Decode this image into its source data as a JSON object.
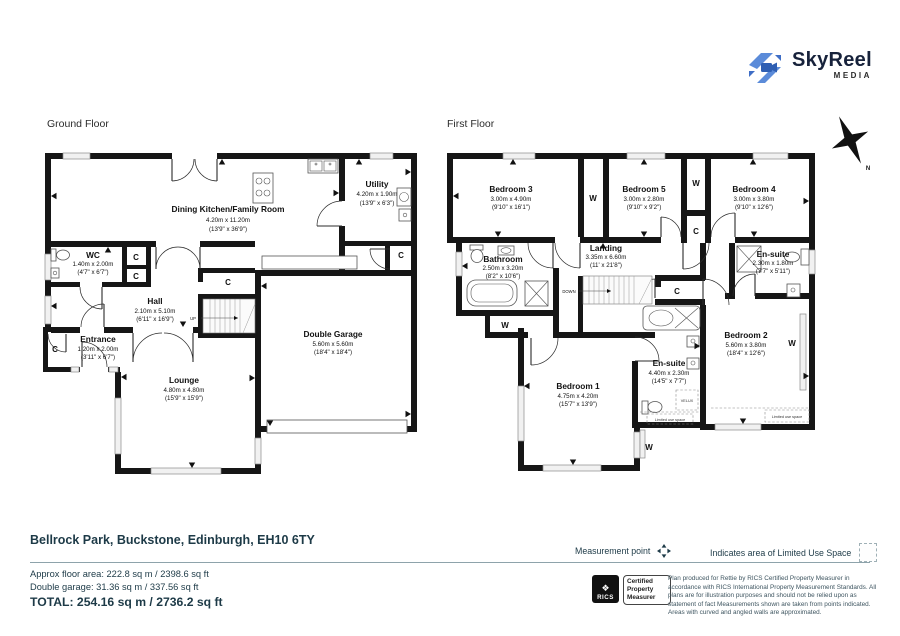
{
  "brand": {
    "name": "SkyReel",
    "tagline": "MEDIA"
  },
  "gf": {
    "title": "Ground Floor",
    "rooms": {
      "kitchen": {
        "name": "Dining Kitchen/Family Room",
        "m": "4.20m x 11.20m",
        "ft": "(13'9\" x 36'9\")"
      },
      "utility": {
        "name": "Utility",
        "m": "4.20m x 1.90m",
        "ft": "(13'9\" x 6'3\")"
      },
      "wc": {
        "name": "WC",
        "m": "1.40m x 2.00m",
        "ft": "(4'7\" x 6'7\")"
      },
      "hall": {
        "name": "Hall",
        "m": "2.10m x 5.10m",
        "ft": "(6'11\" x 16'9\")"
      },
      "entrance": {
        "name": "Entrance",
        "m": "1.20m x 2.00m",
        "ft": "(3'11\" x 6'7\")"
      },
      "lounge": {
        "name": "Lounge",
        "m": "4.80m x 4.80m",
        "ft": "(15'9\" x 15'9\")"
      },
      "garage": {
        "name": "Double Garage",
        "m": "5.60m x 5.60m",
        "ft": "(18'4\" x 18'4\")"
      }
    }
  },
  "ff": {
    "title": "First Floor",
    "rooms": {
      "bedroom3": {
        "name": "Bedroom 3",
        "m": "3.00m x 4.90m",
        "ft": "(9'10\" x 16'1\")"
      },
      "bedroom5": {
        "name": "Bedroom 5",
        "m": "3.00m x 2.80m",
        "ft": "(9'10\" x 9'2\")"
      },
      "bedroom4": {
        "name": "Bedroom 4",
        "m": "3.00m x 3.80m",
        "ft": "(9'10\" x 12'6\")"
      },
      "landing": {
        "name": "Landing",
        "m": "3.35m x 6.60m",
        "ft": "(11' x 21'8\")"
      },
      "bathroom": {
        "name": "Bathroom",
        "m": "2.50m x 3.20m",
        "ft": "(8'2\" x 10'6\")"
      },
      "ensuite_small": {
        "name": "En-suite",
        "m": "2.30m x 1.80m",
        "ft": "(7'7\" x 5'11\")"
      },
      "bedroom1": {
        "name": "Bedroom 1",
        "m": "4.75m x 4.20m",
        "ft": "(15'7\" x 13'9\")"
      },
      "ensuite_large": {
        "name": "En-suite",
        "m": "4.40m x 2.30m",
        "ft": "(14'5\" x 7'7\")"
      },
      "bedroom2": {
        "name": "Bedroom 2",
        "m": "5.60m x 3.80m",
        "ft": "(18'4\" x 12'6\")"
      }
    }
  },
  "labels": {
    "wardrobe": "W",
    "closet": "C",
    "up": "UP",
    "down": "DOWN",
    "velux": "VELUX",
    "limited": "Limited use space",
    "north": "N"
  },
  "address": "Bellrock Park, Buckstone, Edinburgh, EH10 6TY",
  "legend": {
    "measurement": "Measurement point",
    "limited": "Indicates area of  Limited Use Space"
  },
  "areas": {
    "floor": "Approx floor area: 222.8 sq m / 2398.6 sq ft",
    "garage": "Double garage: 31.36 sq m / 337.56 sq ft",
    "total": "TOTAL: 254.16 sq m / 2736.2 sq ft"
  },
  "rics": {
    "name": "RICS",
    "certification": "Certified Property Measurer"
  },
  "disclaimer": "Plan produced for Rettie by RICS Certified Property Measurer in accordance with RICS International Property Measurement Standards. All plans are for illustration purposes and should not be relied upon as statement of fact Measurements shown are taken from points indicated. Areas with curved and angled walls are approximated.",
  "colors": {
    "brand_blue": "#4a7cd1",
    "teal": "#1d3a47"
  }
}
